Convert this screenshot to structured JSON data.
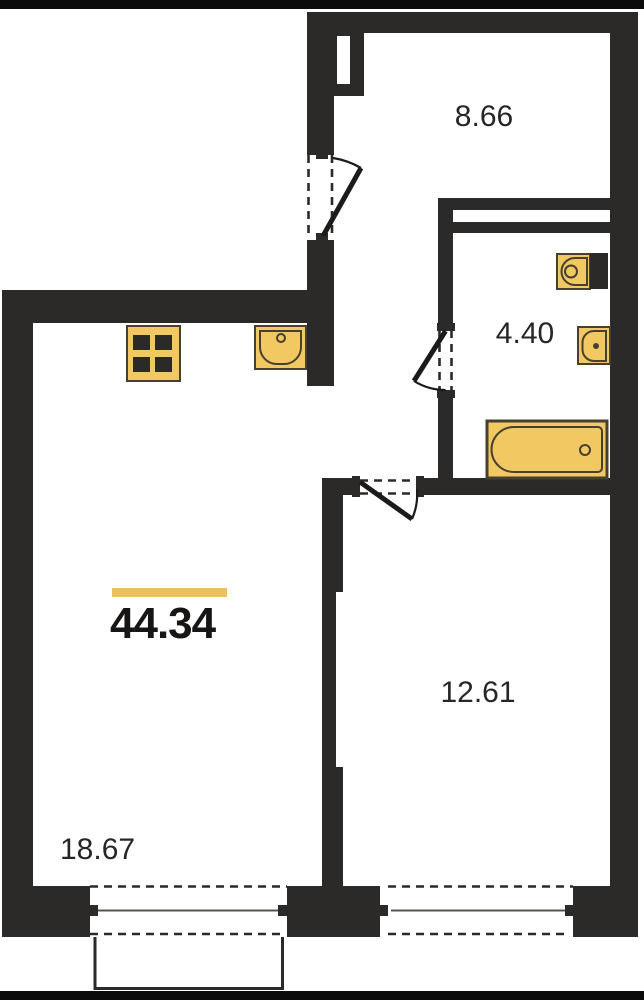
{
  "plan": {
    "areas": {
      "total": "44.34",
      "hall": "8.66",
      "bathroom": "4.40",
      "room": "12.61",
      "living_kitchen": "18.67"
    },
    "fixtures": [
      "stove",
      "kitchen-sink",
      "toilet",
      "washbasin",
      "bathtub"
    ],
    "colors": {
      "wall": "#2b2a28",
      "fixture-fill": "#f2c862",
      "fixture-stroke": "#45402f",
      "accent-bar": "#edc05f",
      "label-text": "#272624",
      "glass-line": "#56544f",
      "letterbox": "#0b0b0b",
      "paper": "#ffffff"
    }
  }
}
